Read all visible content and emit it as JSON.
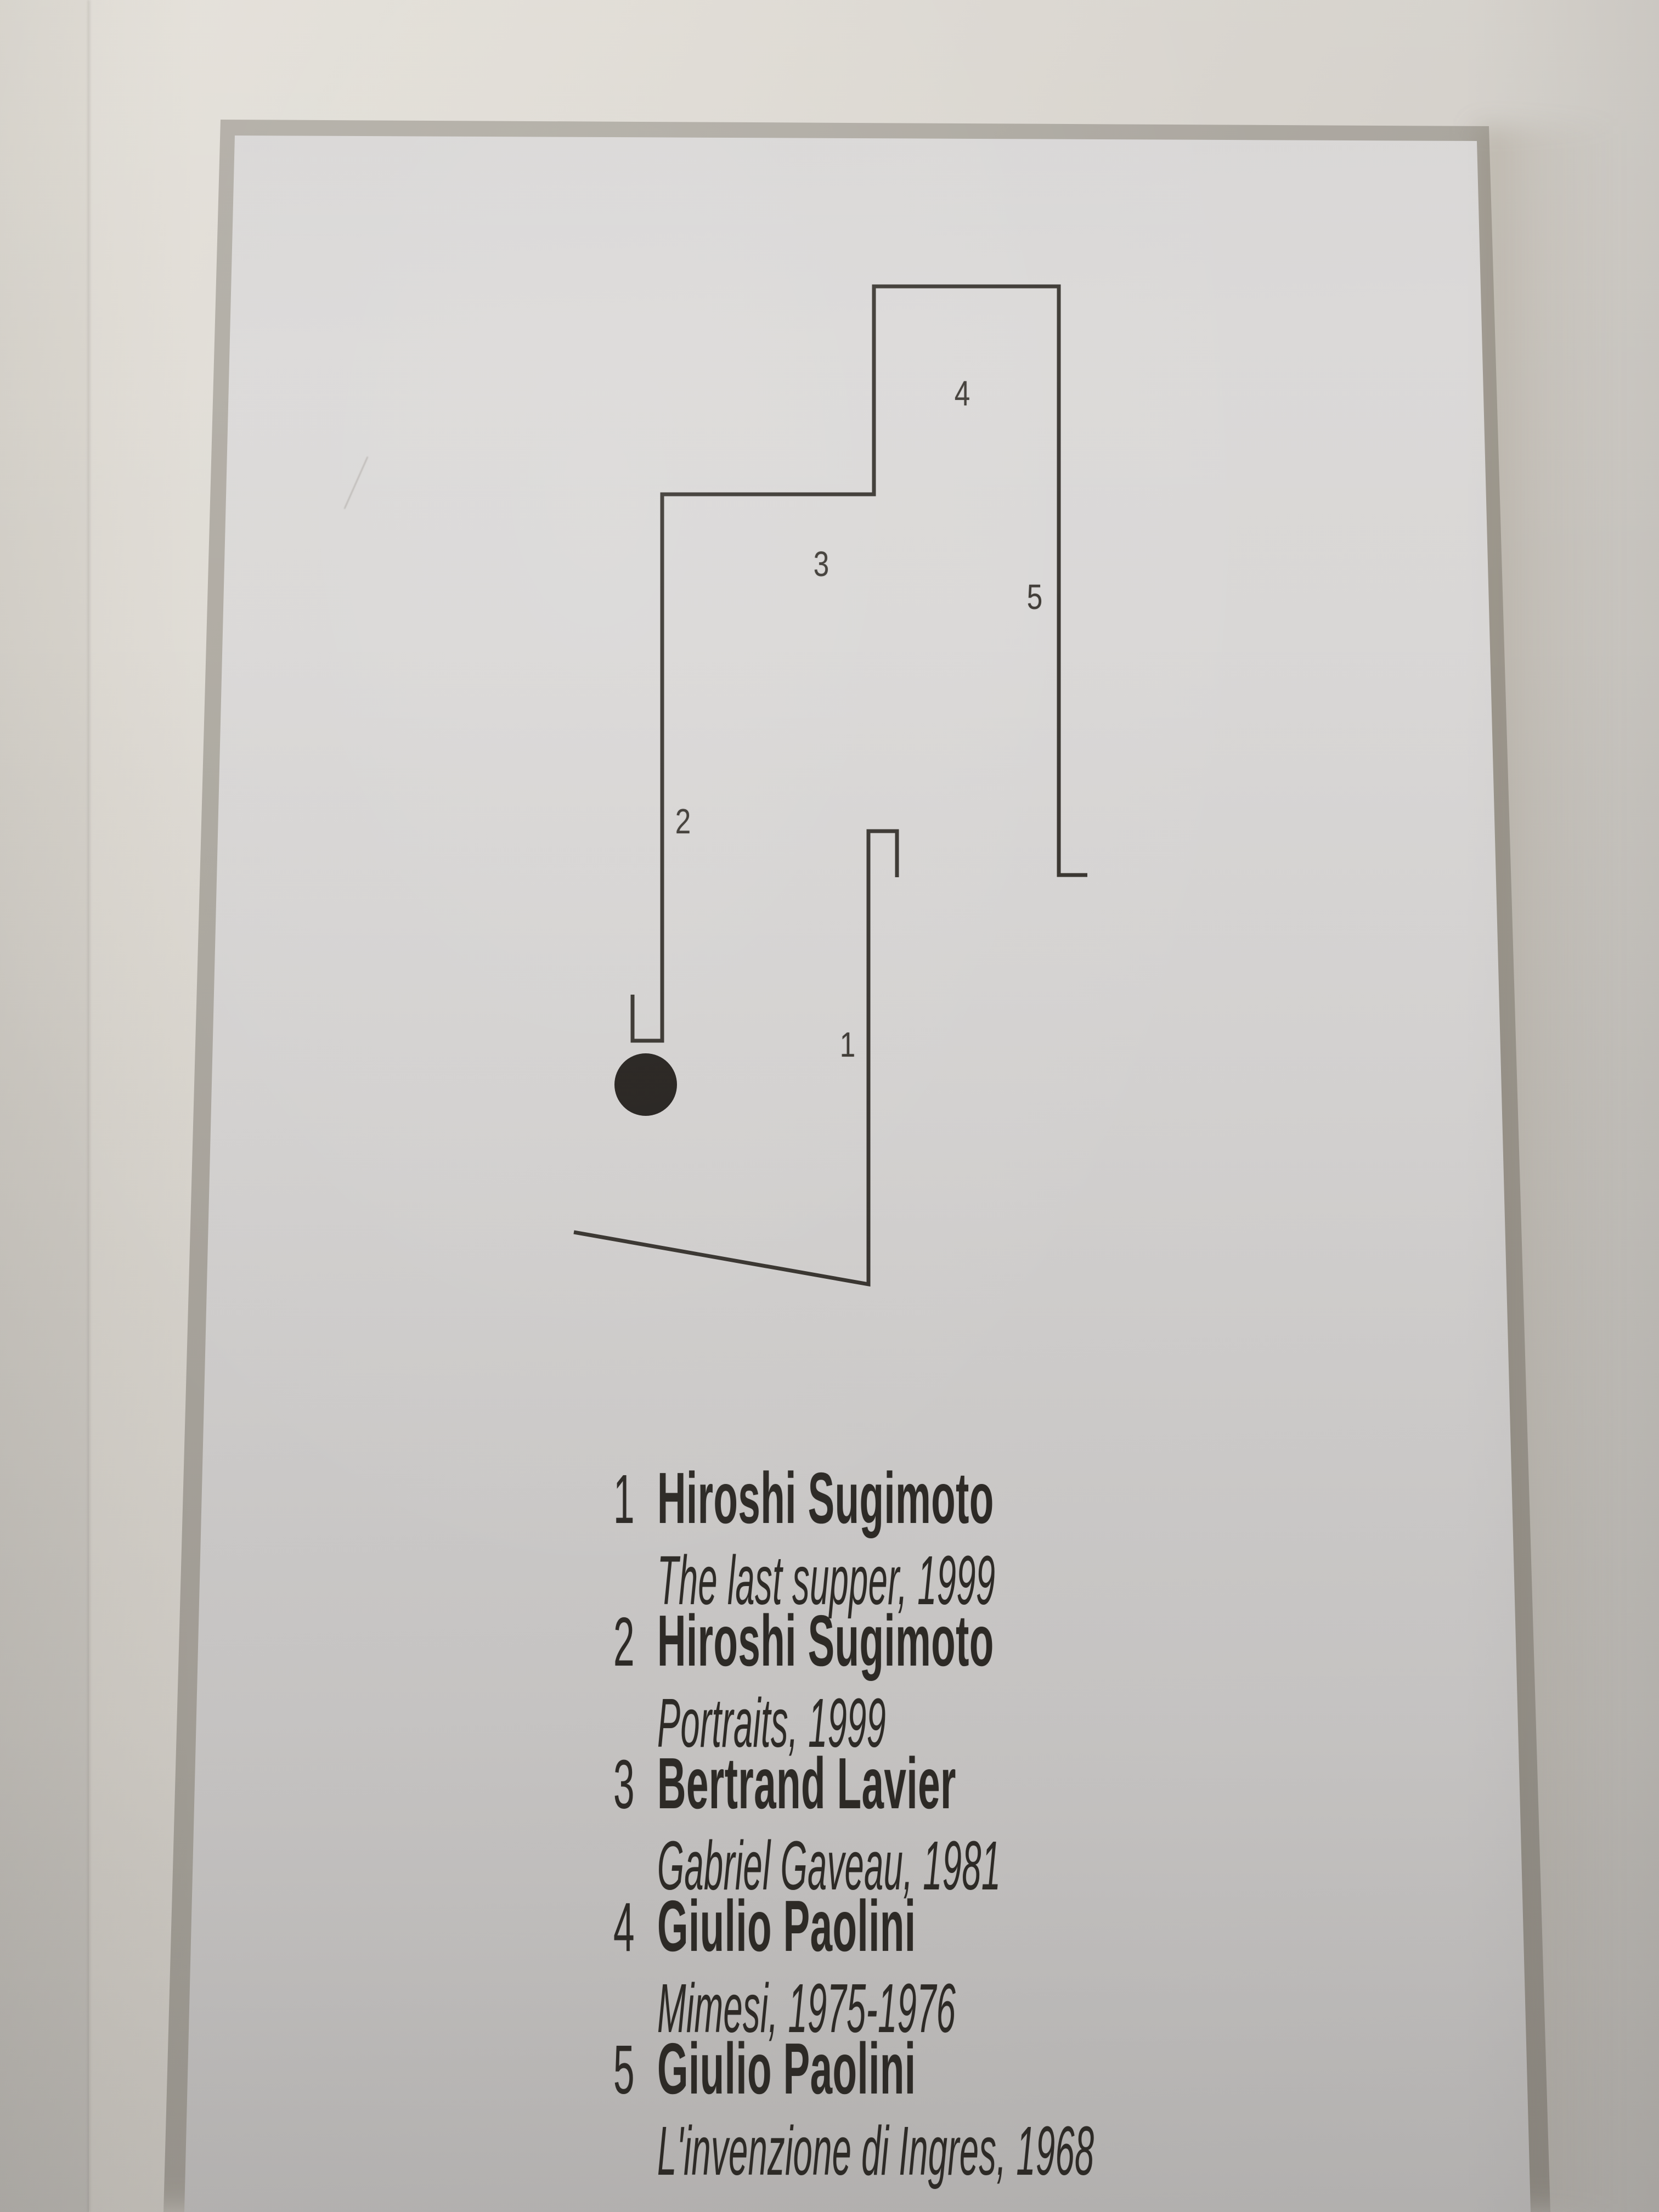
{
  "plan": {
    "markers": [
      {
        "label": "1"
      },
      {
        "label": "2"
      },
      {
        "label": "3"
      },
      {
        "label": "4"
      },
      {
        "label": "5"
      }
    ],
    "line_color": "#36322d",
    "dot_color": "#221e1b"
  },
  "legend": {
    "items": [
      {
        "number": "1",
        "artist": "Hiroshi Sugimoto",
        "title": "The last supper, 1999"
      },
      {
        "number": "2",
        "artist": "Hiroshi Sugimoto",
        "title": "Portraits, 1999"
      },
      {
        "number": "3",
        "artist": "Bertrand Lavier",
        "title": "Gabriel Gaveau, 1981"
      },
      {
        "number": "4",
        "artist": "Giulio Paolini",
        "title": "Mimesi, 1975-1976"
      },
      {
        "number": "5",
        "artist": "Giulio Paolini",
        "title": "L'invenzione di Ingres, 1968"
      }
    ],
    "text_color": "#2d2a26"
  },
  "colors": {
    "panel": "#d7d5d4",
    "wall": "#d4d0ca"
  }
}
